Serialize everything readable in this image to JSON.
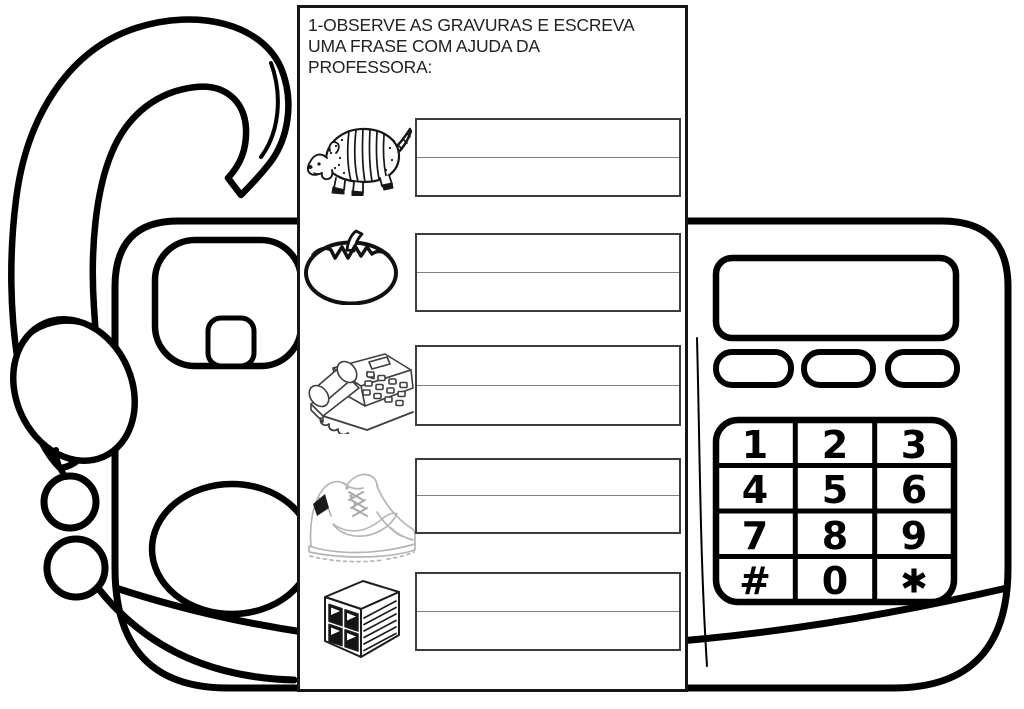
{
  "worksheet": {
    "instruction_lines": [
      "1-OBSERVE AS GRAVURAS E ESCREVA",
      "UMA FRASE COM AJUDA DA",
      "PROFESSORA:"
    ],
    "items": [
      {
        "image": "armadillo",
        "line1": "",
        "line2": ""
      },
      {
        "image": "tomato",
        "line1": "",
        "line2": ""
      },
      {
        "image": "desk-telephone",
        "line1": "",
        "line2": ""
      },
      {
        "image": "sneaker",
        "line1": "",
        "line2": ""
      },
      {
        "image": "concrete-brick",
        "line1": "",
        "line2": ""
      }
    ]
  },
  "phone": {
    "style": "black coloring-book line art of a desk telephone with handset, cord, display and keypad",
    "keypad": {
      "keys": [
        "1",
        "2",
        "3",
        "4",
        "5",
        "6",
        "7",
        "8",
        "9",
        "#",
        "0",
        "✱"
      ]
    }
  },
  "colors": {
    "paper": "#ffffff",
    "ink": "#000000",
    "worksheet_border": "#161616",
    "table_border": "#3c3c3c",
    "table_divider": "#808080",
    "clipart_line": "#3f3f3f",
    "sneaker_line": "#b5b5b5"
  }
}
